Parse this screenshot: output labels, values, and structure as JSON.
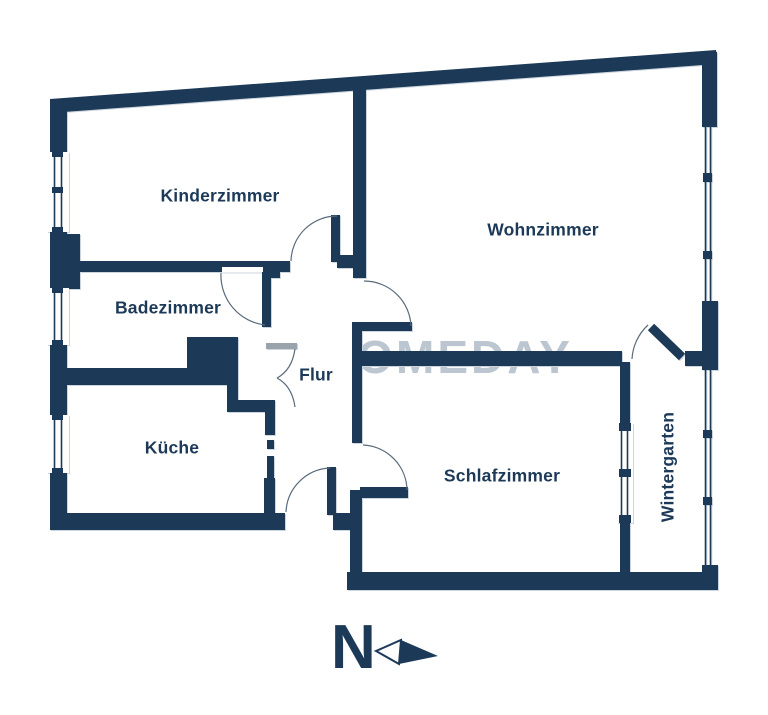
{
  "plan": {
    "rooms": {
      "kinderzimmer": "Kinderzimmer",
      "wohnzimmer": "Wohnzimmer",
      "badezimmer": "Badezimmer",
      "flur": "Flur",
      "kueche": "Küche",
      "schlafzimmer": "Schlafzimmer",
      "wintergarten": "Wintergarten"
    },
    "watermark": "HOMEDAY",
    "compass_label": "N"
  },
  "colors": {
    "wall": "#1c3a58",
    "text": "#1c3a58",
    "watermark": "#bcc6d0",
    "arc": "#5a6b7c",
    "threshold": "#9aa2ab",
    "background": "#ffffff"
  }
}
